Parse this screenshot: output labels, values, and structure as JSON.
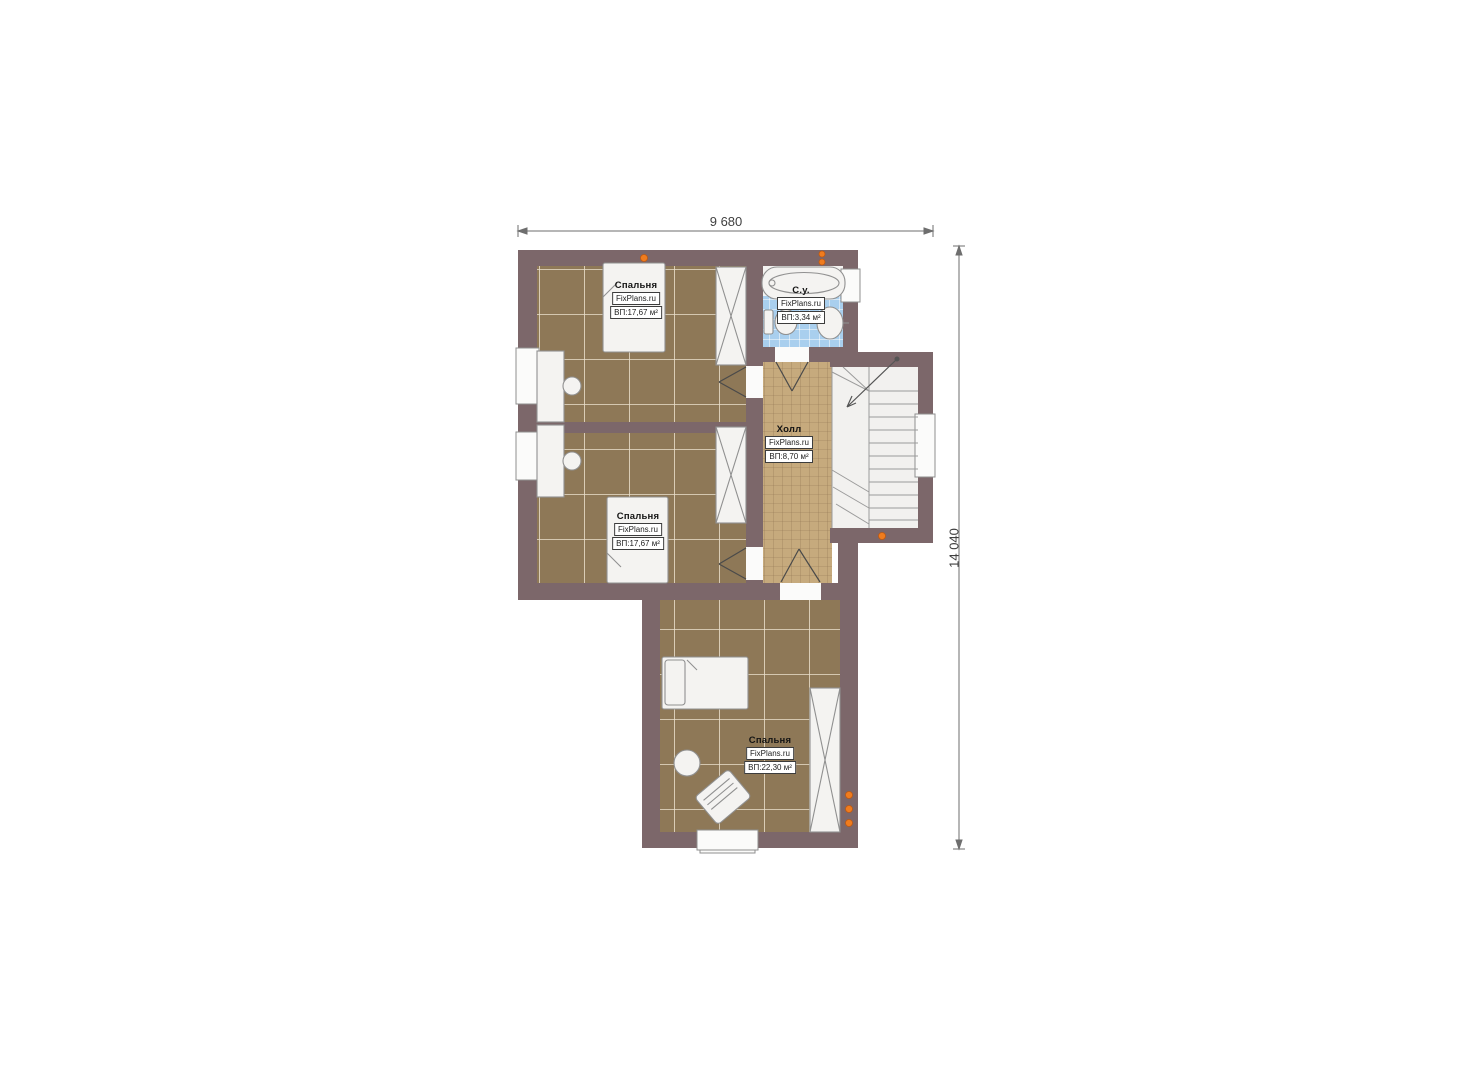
{
  "dimensions": {
    "top": "9 680",
    "right": "14 040"
  },
  "rooms": {
    "bedroom1": {
      "name": "Спальня",
      "brand": "FixPlans.ru",
      "area": "ВП:17,67 м²"
    },
    "bedroom2": {
      "name": "Спальня",
      "brand": "FixPlans.ru",
      "area": "ВП:17,67 м²"
    },
    "bedroom3": {
      "name": "Спальня",
      "brand": "FixPlans.ru",
      "area": "ВП:22,30 м²"
    },
    "hall": {
      "name": "Холл",
      "brand": "FixPlans.ru",
      "area": "ВП:8,70 м²"
    },
    "bathroom": {
      "name": "С.у.",
      "brand": "FixPlans.ru",
      "area": "ВП:3,34 м²"
    }
  },
  "colors": {
    "wall": "#7c676a",
    "bedroom_floor": "#8e7857",
    "hall_floor": "#c6aa7d",
    "bath_tile": "#a9cfee",
    "furniture": "#f4f3f1",
    "radiator": "#f07c1e",
    "dimension_line": "#6e6e6e"
  }
}
